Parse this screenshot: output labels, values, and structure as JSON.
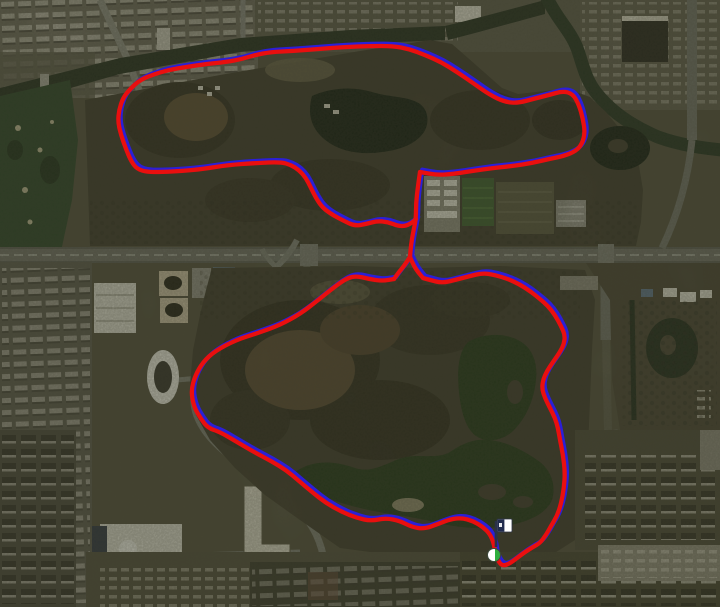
{
  "map": {
    "view": "satellite",
    "width": 720,
    "height": 607,
    "track": {
      "course_color": "#2b1fd6",
      "activity_color": "#e90f0f",
      "stroke_width": 4.3,
      "paths": {
        "upper_loop": [
          [
            420,
            172
          ],
          [
            437,
            175
          ],
          [
            453,
            174
          ],
          [
            472,
            171
          ],
          [
            493,
            168
          ],
          [
            513,
            166
          ],
          [
            532,
            163
          ],
          [
            549,
            159
          ],
          [
            564,
            156
          ],
          [
            576,
            151
          ],
          [
            582,
            144
          ],
          [
            585,
            133
          ],
          [
            583,
            119
          ],
          [
            579,
            105
          ],
          [
            573,
            94
          ],
          [
            563,
            91
          ],
          [
            549,
            95
          ],
          [
            533,
            99
          ],
          [
            518,
            103
          ],
          [
            505,
            102
          ],
          [
            490,
            95
          ],
          [
            473,
            83
          ],
          [
            457,
            72
          ],
          [
            441,
            62
          ],
          [
            425,
            55
          ],
          [
            409,
            49
          ],
          [
            393,
            46
          ],
          [
            370,
            46
          ],
          [
            345,
            47
          ],
          [
            318,
            49
          ],
          [
            293,
            51
          ],
          [
            271,
            52
          ],
          [
            255,
            55
          ],
          [
            242,
            59
          ],
          [
            226,
            62
          ],
          [
            206,
            64
          ],
          [
            186,
            67
          ],
          [
            168,
            70
          ],
          [
            152,
            75
          ],
          [
            140,
            80
          ],
          [
            130,
            89
          ],
          [
            123,
            98
          ],
          [
            119,
            110
          ],
          [
            118,
            122
          ],
          [
            121,
            135
          ],
          [
            126,
            149
          ],
          [
            131,
            161
          ],
          [
            137,
            169
          ],
          [
            147,
            172
          ],
          [
            162,
            172
          ],
          [
            182,
            171
          ],
          [
            203,
            169
          ],
          [
            228,
            165
          ],
          [
            256,
            163
          ],
          [
            281,
            162
          ],
          [
            291,
            165
          ],
          [
            299,
            170
          ],
          [
            306,
            178
          ],
          [
            311,
            188
          ],
          [
            316,
            198
          ],
          [
            322,
            207
          ],
          [
            331,
            214
          ],
          [
            344,
            221
          ],
          [
            355,
            226
          ],
          [
            366,
            224
          ],
          [
            377,
            221
          ],
          [
            388,
            222
          ],
          [
            398,
            226
          ],
          [
            406,
            226
          ],
          [
            413,
            222
          ],
          [
            416,
            219
          ]
        ],
        "connector": [
          [
            420,
            172
          ],
          [
            418,
            186
          ],
          [
            416,
            203
          ],
          [
            416,
            219
          ],
          [
            413,
            233
          ],
          [
            411,
            245
          ],
          [
            410,
            257
          ]
        ],
        "connector_branch_west": [
          [
            410,
            257
          ],
          [
            404,
            266
          ],
          [
            399,
            272
          ],
          [
            394,
            279
          ]
        ],
        "connector_branch_east": [
          [
            410,
            257
          ],
          [
            414,
            266
          ],
          [
            418,
            272
          ],
          [
            423,
            278
          ]
        ],
        "lower_loop": [
          [
            394,
            279
          ],
          [
            382,
            281
          ],
          [
            369,
            279
          ],
          [
            357,
            276
          ],
          [
            347,
            278
          ],
          [
            333,
            288
          ],
          [
            317,
            301
          ],
          [
            300,
            314
          ],
          [
            280,
            325
          ],
          [
            258,
            333
          ],
          [
            236,
            340
          ],
          [
            215,
            351
          ],
          [
            203,
            362
          ],
          [
            195,
            376
          ],
          [
            191,
            391
          ],
          [
            194,
            407
          ],
          [
            201,
            419
          ],
          [
            208,
            428
          ],
          [
            220,
            432
          ],
          [
            237,
            442
          ],
          [
            254,
            452
          ],
          [
            271,
            461
          ],
          [
            286,
            470
          ],
          [
            299,
            481
          ],
          [
            312,
            492
          ],
          [
            326,
            503
          ],
          [
            342,
            512
          ],
          [
            357,
            518
          ],
          [
            371,
            521
          ],
          [
            386,
            518
          ],
          [
            400,
            521
          ],
          [
            412,
            527
          ],
          [
            424,
            529
          ],
          [
            438,
            524
          ],
          [
            451,
            519
          ],
          [
            462,
            518
          ],
          [
            473,
            521
          ],
          [
            483,
            527
          ],
          [
            490,
            534
          ],
          [
            494,
            544
          ],
          [
            495,
            552
          ],
          [
            497,
            559
          ],
          [
            502,
            566
          ],
          [
            509,
            564
          ],
          [
            517,
            558
          ],
          [
            525,
            552
          ],
          [
            533,
            547
          ],
          [
            540,
            543
          ],
          [
            546,
            535
          ],
          [
            551,
            526
          ],
          [
            557,
            516
          ],
          [
            561,
            504
          ],
          [
            564,
            488
          ],
          [
            565,
            472
          ],
          [
            563,
            455
          ],
          [
            560,
            440
          ],
          [
            558,
            428
          ],
          [
            555,
            418
          ],
          [
            550,
            408
          ],
          [
            545,
            398
          ],
          [
            542,
            389
          ],
          [
            543,
            380
          ],
          [
            547,
            371
          ],
          [
            553,
            362
          ],
          [
            560,
            352
          ],
          [
            564,
            344
          ],
          [
            565,
            335
          ],
          [
            561,
            326
          ],
          [
            555,
            315
          ],
          [
            548,
            306
          ],
          [
            540,
            299
          ],
          [
            530,
            291
          ],
          [
            519,
            284
          ],
          [
            508,
            279
          ],
          [
            495,
            275
          ],
          [
            483,
            273
          ],
          [
            470,
            276
          ],
          [
            455,
            280
          ],
          [
            442,
            283
          ],
          [
            430,
            280
          ],
          [
            423,
            278
          ]
        ]
      }
    },
    "markers": {
      "start": {
        "x": 494,
        "y": 555,
        "label": "start",
        "fill": "#ffffff",
        "accent": "#2fae3e",
        "outline": "#3c4a3c"
      },
      "finish": {
        "x": 496,
        "y": 546,
        "label": "finish",
        "flag_fill": "#ffffff",
        "flag_mark": "#222c4e",
        "pole": "#2a3148"
      }
    }
  }
}
